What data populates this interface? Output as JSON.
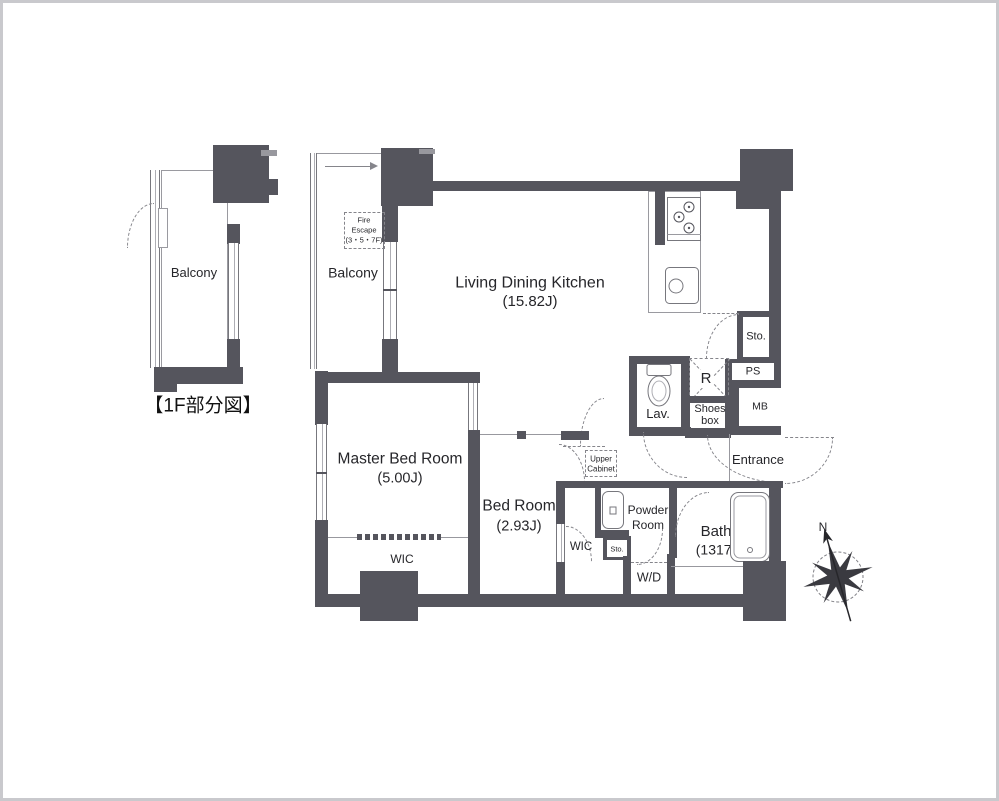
{
  "detail_plan": {
    "balcony_label": "Balcony",
    "caption": "【1F部分図】"
  },
  "main_plan": {
    "balcony_label": "Balcony",
    "fire_escape": {
      "line1": "Fire",
      "line2": "Escape",
      "line3": "(3・5・7F)"
    },
    "ldk": {
      "name": "Living Dining Kitchen",
      "size": "(15.82J)"
    },
    "master_bedroom": {
      "name": "Master Bed Room",
      "size": "(5.00J)"
    },
    "bedroom": {
      "name": "Bed Room",
      "size": "(2.93J)"
    },
    "bath": {
      "name": "Bath",
      "size": "(1317)"
    },
    "wic_master": "WIC",
    "wic_second": "WIC",
    "upper_cabinet": {
      "line1": "Upper",
      "line2": "Cabinet"
    },
    "powder_room": {
      "line1": "Powder",
      "line2": "Room"
    },
    "storage_small": "Sto.",
    "washer_dryer": "W/D",
    "lavatory": "Lav.",
    "shoes_box": {
      "line1": "Shoes",
      "line2": "box"
    },
    "entrance": "Entrance",
    "storage_top": "Sto.",
    "pipe_space": "PS",
    "meter_box": "MB",
    "refrigerator": "R",
    "compass_north": "N"
  },
  "colors": {
    "wall": "#55555d",
    "thin_line": "#98989e",
    "dashed": "#85858b",
    "text": "#26262a"
  }
}
